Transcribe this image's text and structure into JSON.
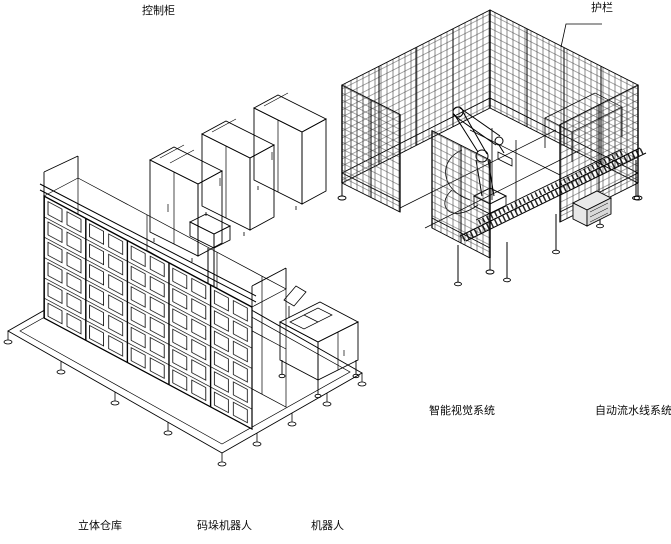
{
  "canvas": {
    "background": "#ffffff",
    "line_color": "#000000",
    "width": 671,
    "height": 544
  },
  "labels": {
    "control_cabinet": "控制柜",
    "fence": "护栏",
    "vision_system": "智能视觉系统",
    "line_system": "自动流水线系统",
    "warehouse": "立体仓库",
    "palletizing_robot": "码垛机器人",
    "robot": "机器人"
  }
}
